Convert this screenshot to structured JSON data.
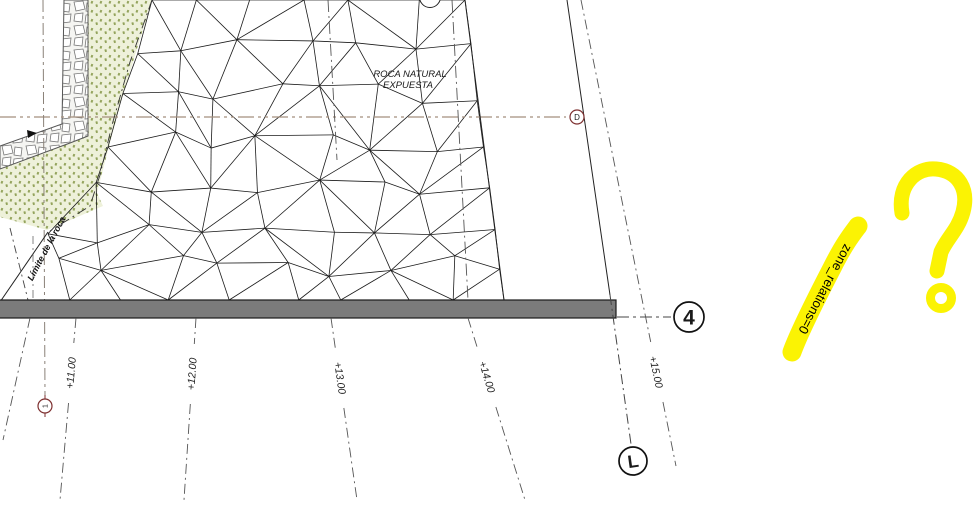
{
  "page": {
    "background": "#ffffff"
  },
  "drawing": {
    "texts": [
      {
        "value": "ROCA NATURAL",
        "x": 410,
        "y": 77,
        "size": 9.5,
        "style": "italic",
        "weight": "normal",
        "rot": 0,
        "anchor": "middle",
        "color": "#1a1a1a",
        "name": "label-roca-natural-line1"
      },
      {
        "value": "EXPUESTA",
        "x": 408,
        "y": 88,
        "size": 9.5,
        "style": "italic",
        "weight": "normal",
        "rot": 0,
        "anchor": "middle",
        "color": "#1a1a1a",
        "name": "label-roca-natural-line2"
      },
      {
        "value": "Límite de la roca",
        "x": 49,
        "y": 250,
        "size": 9,
        "style": "italic",
        "weight": "bold",
        "rot": -62,
        "anchor": "middle",
        "color": "#111111",
        "name": "label-limite-de-la-roca"
      }
    ],
    "stations": [
      {
        "value": "+11.00",
        "x": 71,
        "y": 373,
        "rot": -85,
        "line": [
          76,
          318,
          60,
          500
        ]
      },
      {
        "value": "+12.00",
        "x": 192,
        "y": 374,
        "rot": -86,
        "line": [
          196,
          318,
          184,
          500
        ]
      },
      {
        "value": "+13.00",
        "x": 340,
        "y": 378,
        "rot": 82,
        "line": [
          331,
          318,
          357,
          500
        ]
      },
      {
        "value": "+14.00",
        "x": 487,
        "y": 377,
        "rot": 73,
        "line": [
          468,
          318,
          525,
          500
        ]
      },
      {
        "value": "+15.00",
        "x": 656,
        "y": 372,
        "rot": 78,
        "line": [
          581,
          0,
          676,
          466
        ]
      }
    ],
    "markers": [
      {
        "value": "D",
        "cx": 577,
        "cy": 117,
        "r": 7,
        "stroke": "#7d2f2f",
        "fontSize": 8,
        "bold": false,
        "textRot": 0,
        "ticks": false
      },
      {
        "value": "1",
        "cx": 45,
        "cy": 406,
        "r": 7,
        "stroke": "#7d2f2f",
        "fontSize": 7,
        "bold": false,
        "textRot": -90,
        "ticks": true
      },
      {
        "value": "4",
        "cx": 689,
        "cy": 317,
        "r": 15,
        "stroke": "#111111",
        "fontSize": 21,
        "bold": true,
        "textRot": 0,
        "ticks": false
      },
      {
        "value": "L",
        "cx": 633,
        "cy": 461,
        "r": 14,
        "stroke": "#111111",
        "fontSize": 18,
        "bold": true,
        "textRot": -8,
        "ticks": false
      }
    ],
    "lines": [
      {
        "name": "grid-line-d",
        "pts": [
          [
            0,
            117
          ],
          [
            566,
            117
          ]
        ],
        "color": "#a58f7d",
        "dash": "16 4 3 4 3 4",
        "w": 1.2,
        "above": false
      },
      {
        "name": "grid-line-1",
        "pts": [
          [
            43,
            0
          ],
          [
            45,
            396
          ]
        ],
        "color": "#8a8178",
        "dash": "12 4 3 4",
        "w": 1,
        "above": false
      },
      {
        "name": "vert-dashdot-mid",
        "pts": [
          [
            328,
            0
          ],
          [
            337,
            160
          ]
        ],
        "color": "#555555",
        "dash": "12 4 2 4",
        "w": 0.9,
        "above": false
      },
      {
        "name": "vert-dashdot-right",
        "pts": [
          [
            452,
            0
          ],
          [
            468,
            300
          ]
        ],
        "color": "#555555",
        "dash": "12 4 2 4",
        "w": 0.9,
        "above": false
      },
      {
        "name": "vegetation-edge-line",
        "pts": [
          [
            152,
            0
          ],
          [
            130,
            62
          ],
          [
            112,
            125
          ],
          [
            100,
            175
          ],
          [
            90,
            206
          ],
          [
            50,
            231
          ]
        ],
        "color": "#333333",
        "dash": "10 4 2 4",
        "w": 0.9,
        "above": false
      },
      {
        "name": "mesh-right-boundary",
        "pts": [
          [
            465,
            0
          ],
          [
            504,
            300
          ]
        ],
        "color": "#222222",
        "dash": null,
        "w": 1,
        "above": false
      },
      {
        "name": "rock-tip-line",
        "pts": [
          [
            48,
            232
          ],
          [
            0,
            302
          ]
        ],
        "color": "#222222",
        "dash": null,
        "w": 1,
        "above": false
      },
      {
        "name": "limite-dash-a",
        "pts": [
          [
            10,
            228
          ],
          [
            28,
            300
          ]
        ],
        "color": "#444444",
        "dash": "8 4 2 4",
        "w": 0.9,
        "above": false
      },
      {
        "name": "limite-dash-b",
        "pts": [
          [
            33,
            236
          ],
          [
            33,
            300
          ]
        ],
        "color": "#666666",
        "dash": "8 4 2 4",
        "w": 0.8,
        "above": false
      },
      {
        "name": "below-bar-left-dash",
        "pts": [
          [
            30,
            318
          ],
          [
            3,
            440
          ]
        ],
        "color": "#555555",
        "dash": "10 4 2 4",
        "w": 0.9,
        "above": true
      },
      {
        "name": "axis-to-grid-4",
        "pts": [
          [
            617,
            317
          ],
          [
            671,
            317
          ]
        ],
        "color": "#444444",
        "dash": "12 4 3 4",
        "w": 1,
        "above": true
      },
      {
        "name": "grid-line-l-solid",
        "pts": [
          [
            567,
            0
          ],
          [
            610,
            295
          ]
        ],
        "color": "#222222",
        "dash": null,
        "w": 1,
        "above": true
      },
      {
        "name": "grid-line-l-dash",
        "pts": [
          [
            610,
            295
          ],
          [
            631,
            444
          ]
        ],
        "color": "#444444",
        "dash": "10 4 2 4",
        "w": 1,
        "above": true
      }
    ],
    "shapes": {
      "vegetation": {
        "points": [
          [
            88,
            0
          ],
          [
            152,
            0
          ],
          [
            136,
            52
          ],
          [
            120,
            105
          ],
          [
            106,
            158
          ],
          [
            97,
            193
          ],
          [
            103,
            206
          ],
          [
            47,
            230
          ],
          [
            0,
            217
          ],
          [
            0,
            169
          ],
          [
            70,
            143
          ],
          [
            88,
            136
          ]
        ],
        "bg": "#eef1da",
        "dot": "#93a35b"
      },
      "wall": {
        "points": [
          [
            64,
            0
          ],
          [
            88,
            0
          ],
          [
            88,
            136
          ],
          [
            70,
            143
          ],
          [
            0,
            169
          ],
          [
            0,
            146
          ],
          [
            62,
            124
          ]
        ],
        "stroke": "#555555"
      },
      "wall_tick": {
        "points": [
          [
            27,
            130
          ],
          [
            37,
            133
          ],
          [
            28,
            138
          ]
        ]
      },
      "bar": {
        "x": -4,
        "y": 300,
        "w": 620,
        "h": 18,
        "fill": "#7b7b7b",
        "stroke": "#1a1a1a"
      },
      "top_circle": {
        "cx": 430,
        "cy": -3,
        "r": 10.5
      }
    },
    "mesh": {
      "rows": [
        0,
        46,
        94,
        142,
        190,
        232,
        266,
        300
      ],
      "spacing": 54,
      "seed": 11,
      "stroke": "#1b1b1b",
      "w": 0.8
    },
    "annotations": {
      "highlight_text": "zone_relations=0",
      "highlight_color": "#fbf303",
      "highlight_text_color": "#000000",
      "question_mark_color": "#fbf303"
    }
  }
}
